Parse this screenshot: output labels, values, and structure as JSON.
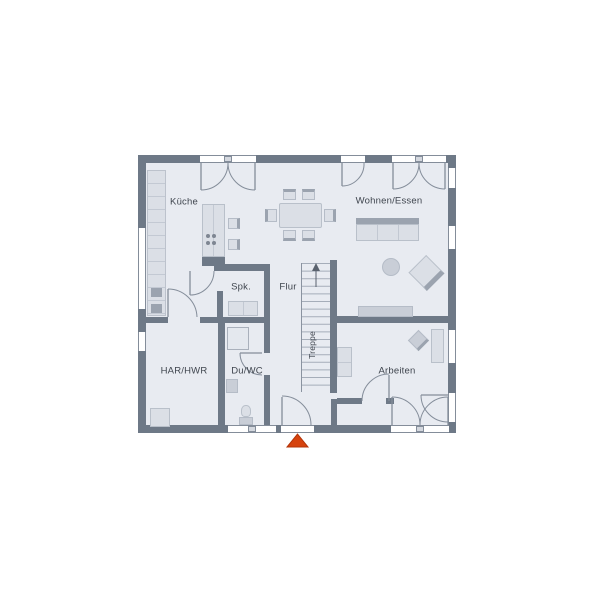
{
  "plan": {
    "type": "floor-plan-ground-floor",
    "labels": {
      "kueche": "Küche",
      "wohnen_essen": "Wohnen/Essen",
      "spk": "Spk.",
      "flur": "Flur",
      "treppe": "Treppe",
      "har_hwr": "HAR/HWR",
      "du_wc": "Du/WC",
      "arbeiten": "Arbeiten"
    },
    "colors": {
      "background": "#ffffff",
      "wall": "#6e7987",
      "floor": "#e8ebf1",
      "furniture_light": "#dbdfe6",
      "furniture_mid": "#c9ced7",
      "furniture_dark": "#9ba3af",
      "line": "#848d9a",
      "window_fill": "#ffffff",
      "label_text": "#3f454e",
      "entrance_arrow": "#d6430e"
    }
  }
}
